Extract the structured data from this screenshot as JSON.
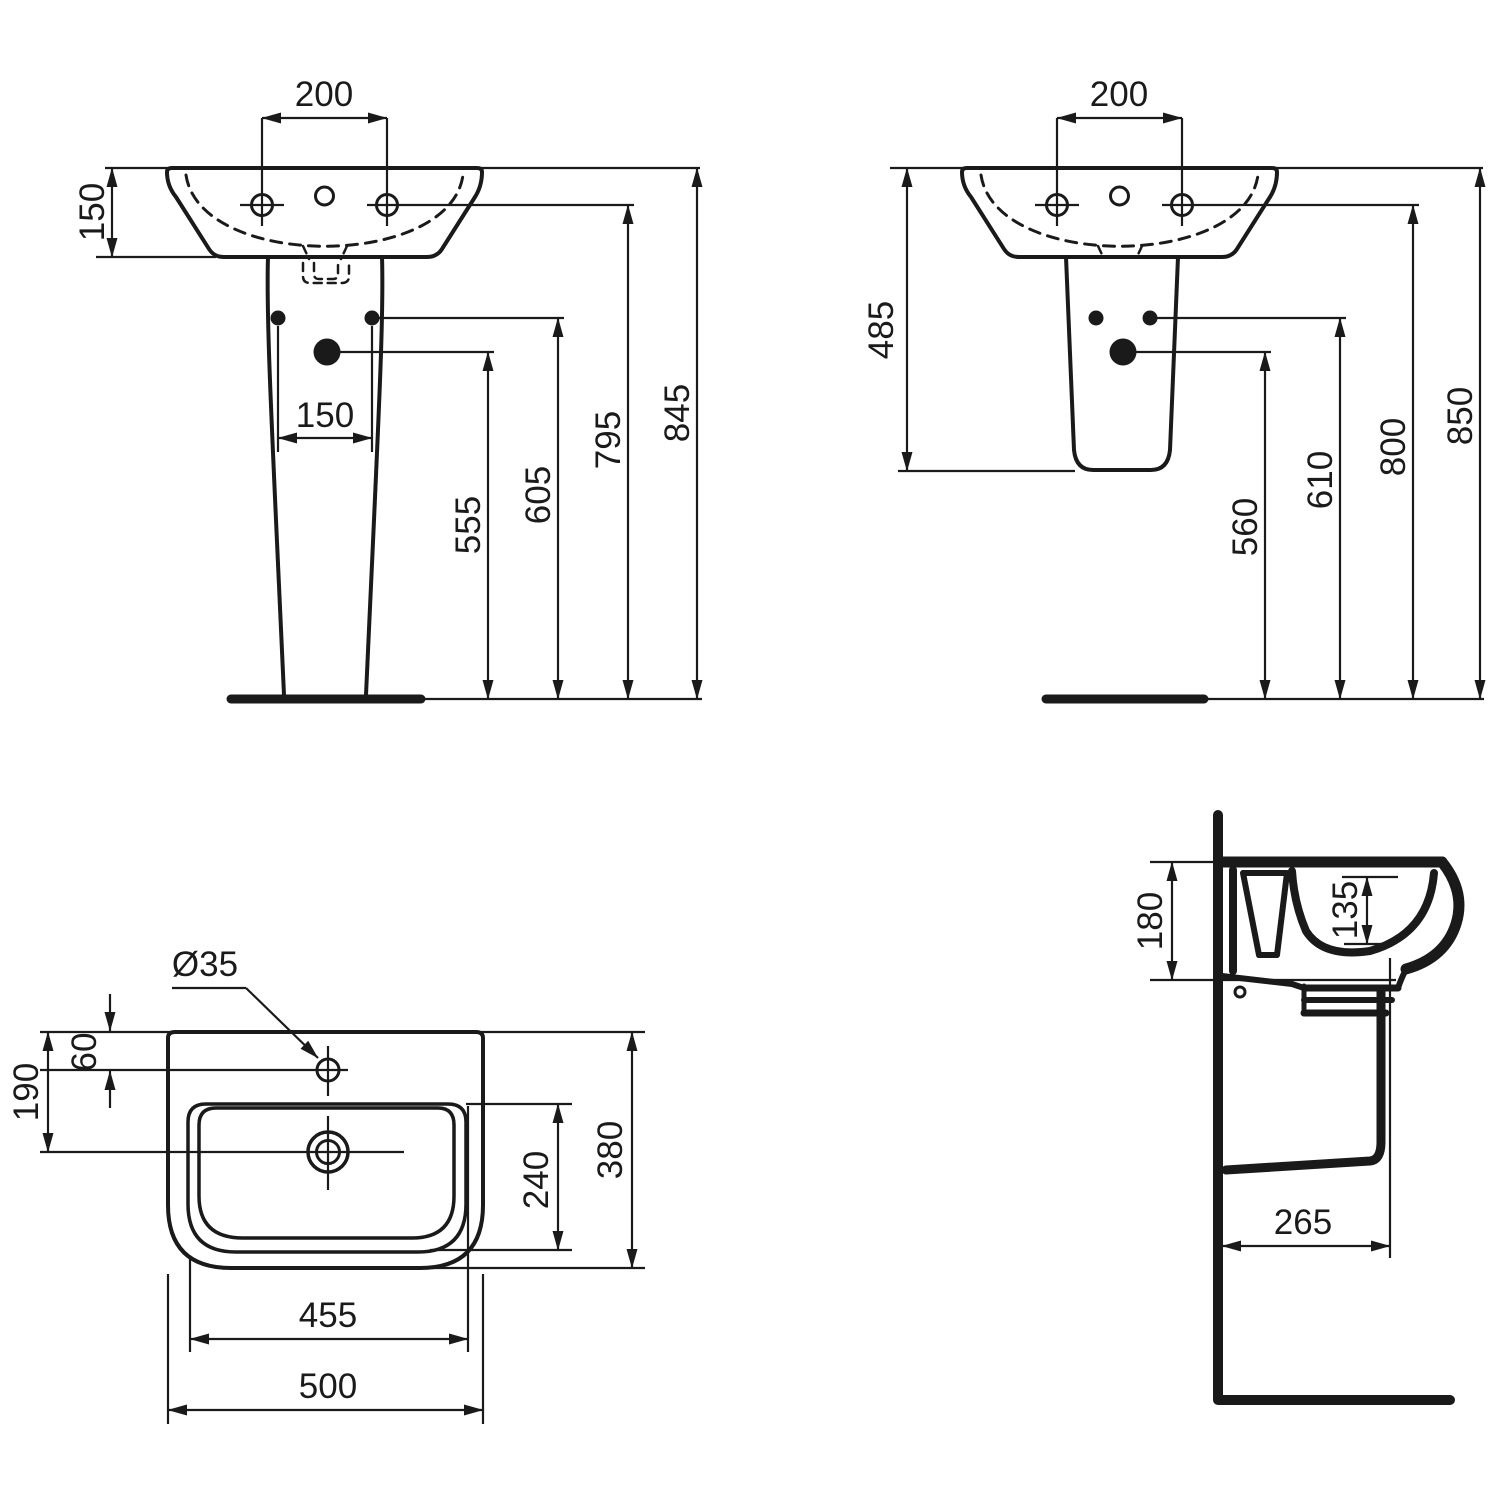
{
  "colors": {
    "background": "#ffffff",
    "ink": "#1a1a1a"
  },
  "views": {
    "front_full_pedestal": {
      "dims": {
        "tap_hole_centres": "200",
        "rim_to_basin_underside": "150",
        "pedestal_fixing_centres": "150",
        "floor_to_drain_fixing": "555",
        "floor_to_pedestal_fixings": "605",
        "floor_to_tap_holes": "795",
        "floor_to_rim": "845"
      }
    },
    "front_semi_pedestal": {
      "dims": {
        "tap_hole_centres": "200",
        "rim_to_semi_pedestal_bottom": "485",
        "floor_to_drain_fixing": "560",
        "floor_to_fixings": "610",
        "floor_to_tap_holes": "800",
        "floor_to_rim": "850"
      }
    },
    "plan": {
      "dims": {
        "tap_hole_diameter": "Ø35",
        "rear_edge_to_tap_hole": "60",
        "rear_edge_to_drain": "190",
        "bowl_depth": "240",
        "overall_depth": "380",
        "bowl_width": "455",
        "overall_width": "500"
      }
    },
    "side_section": {
      "dims": {
        "rim_to_underside": "180",
        "bowl_inner_depth": "135",
        "wall_to_front": "265"
      }
    }
  }
}
